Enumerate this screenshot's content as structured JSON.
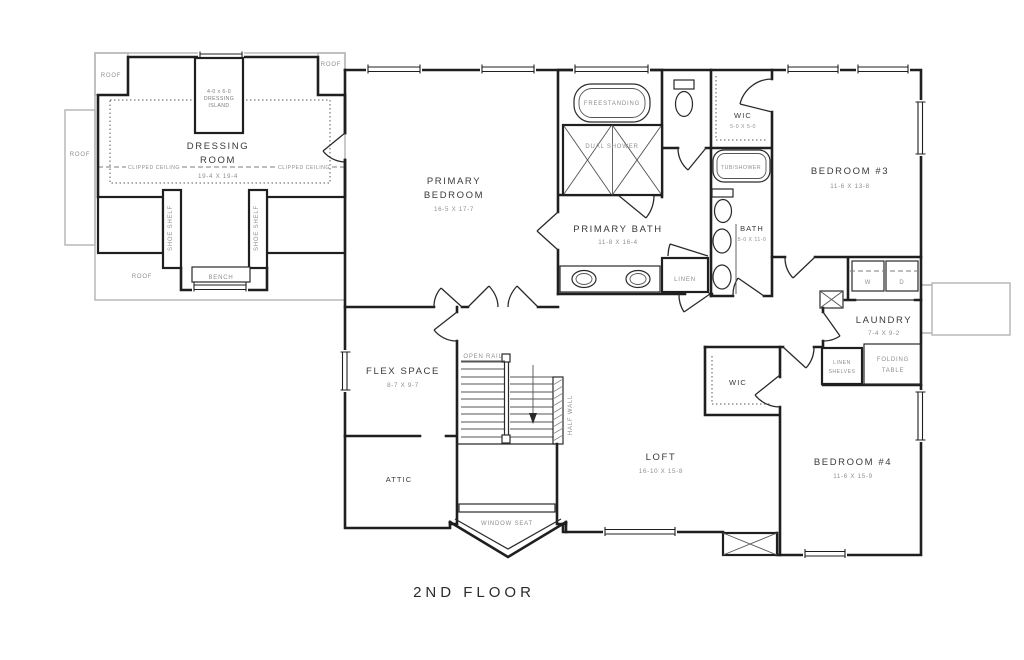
{
  "title": "2ND FLOOR",
  "colors": {
    "wall": "#1f1f1f",
    "roof_gray": "#b3b3b3",
    "label_dark": "#3a3a3a",
    "label_gray": "#8f8f8f",
    "background": "#ffffff"
  },
  "rooms": {
    "dressing_line1": "DRESSING",
    "dressing_line2": "ROOM",
    "dressing_dims": "19-4 X 19-4",
    "primary_line1": "PRIMARY",
    "primary_line2": "BEDROOM",
    "primary_dims": "16-5 X 17-7",
    "primary_bath": "PRIMARY BATH",
    "primary_bath_dims": "11-8 X 16-4",
    "wic": "WIC",
    "wic_dims": "5-0 X 5-0",
    "bath": "BATH",
    "bath_dims": "5-0 X 11-0",
    "bedroom3": "BEDROOM #3",
    "bedroom3_dims": "11-6 X 13-8",
    "bedroom4": "BEDROOM #4",
    "bedroom4_dims": "11-6 X 15-9",
    "laundry": "LAUNDRY",
    "laundry_dims": "7-4 X 9-2",
    "flex": "FLEX SPACE",
    "flex_dims": "8-7 X 9-7",
    "attic": "ATTIC",
    "loft": "LOFT",
    "loft_dims": "16-10 X 15-8",
    "wic4": "WIC"
  },
  "fixtures": {
    "island_line1": "4-0 x 6-0",
    "island_line2": "DRESSING",
    "island_line3": "ISLAND",
    "freestanding": "FREESTANDING",
    "dual_shower": "DUAL SHOWER",
    "tub_shower": "TUB/SHOWER",
    "linen": "LINEN",
    "washer": "W",
    "dryer": "D",
    "linen_shelves_1": "LINEN",
    "linen_shelves_2": "SHELVES",
    "folding_1": "FOLDING",
    "folding_2": "TABLE",
    "bench": "BENCH",
    "shoe_shelf": "SHOE SHELF",
    "window_seat": "WINDOW SEAT",
    "open_rail": "OPEN RAIL",
    "half_wall": "HALF WALL",
    "clipped_ceiling": "CLIPPED CEILING",
    "roof": "ROOF"
  }
}
